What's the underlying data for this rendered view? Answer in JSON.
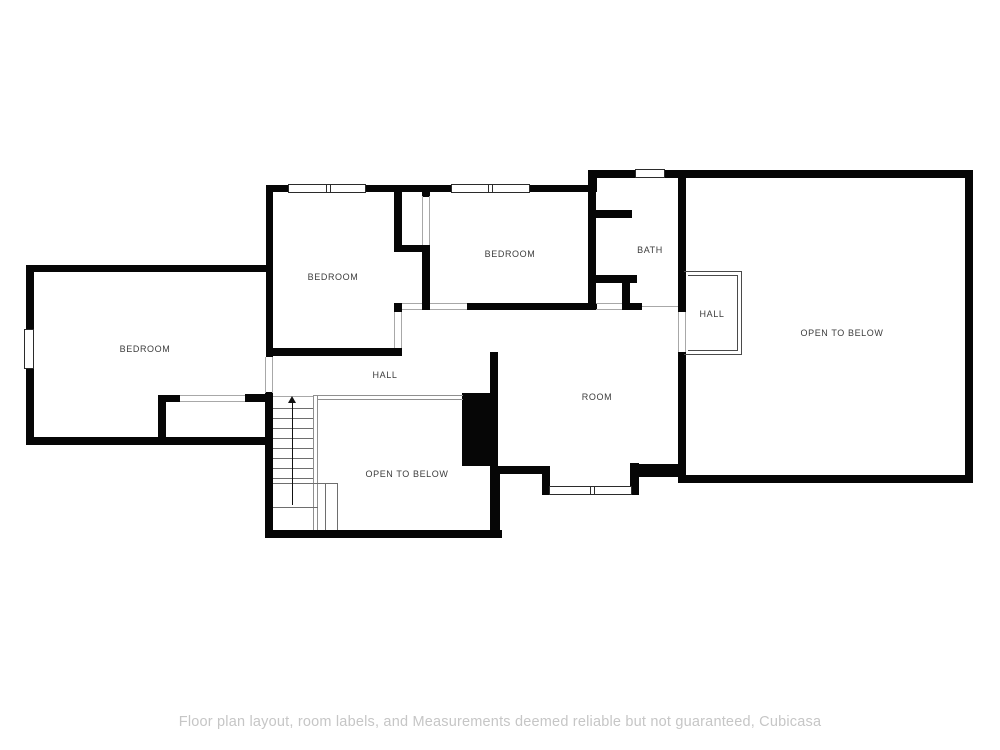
{
  "page": {
    "width": 1000,
    "height": 750,
    "background": "#ffffff"
  },
  "footer": {
    "disclaimer": "Floor plan layout, room labels, and Measurements deemed reliable but not guaranteed, Cubicasa",
    "color": "#c6c6c6"
  },
  "floorplan": {
    "colors": {
      "wall": "#060606",
      "solid_mass": "#060606",
      "window_border": "#2b2b2b",
      "opening_line": "#a8a8a8",
      "boundary_line": "#8f8f8f",
      "railing_line": "#4a4a4a",
      "stair_line": "#6e6e6e",
      "arrow": "#111111",
      "label": "#3c3c3c"
    },
    "labels": [
      {
        "id": "bedroom-west",
        "text": "BEDROOM",
        "x": 145,
        "y": 349
      },
      {
        "id": "bedroom-mid",
        "text": "BEDROOM",
        "x": 333,
        "y": 277
      },
      {
        "id": "bedroom-north",
        "text": "BEDROOM",
        "x": 510,
        "y": 254
      },
      {
        "id": "bath",
        "text": "BATH",
        "x": 650,
        "y": 250
      },
      {
        "id": "hall-east",
        "text": "HALL",
        "x": 712,
        "y": 314
      },
      {
        "id": "hall-west",
        "text": "HALL",
        "x": 385,
        "y": 375
      },
      {
        "id": "room",
        "text": "ROOM",
        "x": 597,
        "y": 397
      },
      {
        "id": "open-to-below-east",
        "text": "OPEN TO BELOW",
        "x": 842,
        "y": 333
      },
      {
        "id": "open-to-below-stair",
        "text": "OPEN TO BELOW",
        "x": 407,
        "y": 474
      }
    ],
    "walls": [
      [
        266,
        185,
        24,
        7
      ],
      [
        364,
        185,
        89,
        7
      ],
      [
        528,
        185,
        62,
        7
      ],
      [
        588,
        170,
        9,
        22
      ],
      [
        588,
        170,
        49,
        8
      ],
      [
        663,
        170,
        310,
        8
      ],
      [
        965,
        170,
        8,
        313
      ],
      [
        678,
        475,
        295,
        8
      ],
      [
        678,
        170,
        8,
        142
      ],
      [
        678,
        352,
        8,
        131
      ],
      [
        266,
        185,
        7,
        172
      ],
      [
        26,
        265,
        247,
        7
      ],
      [
        26,
        265,
        8,
        180
      ],
      [
        26,
        437,
        247,
        8
      ],
      [
        158,
        395,
        8,
        50
      ],
      [
        158,
        395,
        22,
        7
      ],
      [
        245,
        394,
        28,
        8
      ],
      [
        265,
        392,
        8,
        146
      ],
      [
        265,
        530,
        237,
        8
      ],
      [
        490,
        466,
        10,
        72
      ],
      [
        266,
        348,
        136,
        8
      ],
      [
        394,
        192,
        8,
        58
      ],
      [
        394,
        245,
        36,
        7
      ],
      [
        422,
        245,
        8,
        65
      ],
      [
        394,
        303,
        8,
        9
      ],
      [
        422,
        192,
        8,
        5
      ],
      [
        467,
        303,
        130,
        7
      ],
      [
        588,
        170,
        8,
        140
      ],
      [
        596,
        210,
        36,
        8
      ],
      [
        596,
        275,
        41,
        8
      ],
      [
        622,
        275,
        8,
        35
      ],
      [
        622,
        303,
        20,
        7
      ],
      [
        490,
        352,
        8,
        48
      ],
      [
        498,
        466,
        52,
        8
      ],
      [
        542,
        466,
        8,
        29
      ],
      [
        630,
        463,
        9,
        32
      ],
      [
        639,
        464,
        43,
        13
      ]
    ],
    "solids": [
      [
        462,
        393,
        36,
        73
      ]
    ],
    "windows": [
      {
        "rect": [
          288,
          184,
          78,
          9
        ],
        "mullion_x": 327
      },
      {
        "rect": [
          451,
          184,
          79,
          9
        ],
        "mullion_x": 489
      },
      {
        "rect": [
          635,
          169,
          30,
          9
        ],
        "mullion_x": null
      },
      {
        "rect": [
          24,
          329,
          10,
          40
        ],
        "mullion_x": null
      },
      {
        "rect": [
          549,
          486,
          83,
          9
        ],
        "mullion_x": 591
      }
    ],
    "opening_lines": [
      [
        265,
        357,
        1,
        36
      ],
      [
        272,
        357,
        1,
        36
      ],
      [
        394,
        312,
        1,
        36
      ],
      [
        401,
        312,
        1,
        36
      ],
      [
        430,
        303,
        37,
        1
      ],
      [
        430,
        309,
        37,
        1
      ],
      [
        422,
        196,
        1,
        49
      ],
      [
        429,
        196,
        1,
        49
      ],
      [
        402,
        303,
        20,
        1
      ],
      [
        402,
        309,
        20,
        1
      ],
      [
        596,
        303,
        26,
        1
      ],
      [
        596,
        309,
        26,
        1
      ],
      [
        642,
        306,
        36,
        1
      ],
      [
        180,
        395,
        65,
        1
      ],
      [
        180,
        401,
        65,
        1
      ],
      [
        273,
        396,
        40,
        1
      ],
      [
        678,
        312,
        1,
        40
      ],
      [
        685,
        312,
        1,
        40
      ]
    ],
    "railing_lines": [
      [
        684,
        271,
        58,
        1
      ],
      [
        741,
        271,
        1,
        84
      ],
      [
        684,
        354,
        58,
        1
      ],
      [
        688,
        275,
        50,
        1
      ],
      [
        737,
        275,
        1,
        76
      ],
      [
        688,
        350,
        50,
        1
      ]
    ],
    "boundary_lines": [
      [
        313,
        395,
        1,
        135
      ],
      [
        317,
        395,
        1,
        135
      ],
      [
        313,
        395,
        150,
        1
      ],
      [
        317,
        399,
        146,
        1
      ]
    ],
    "stair": {
      "treads": [
        [
          273,
          408,
          40,
          1
        ],
        [
          273,
          418,
          40,
          1
        ],
        [
          273,
          428,
          40,
          1
        ],
        [
          273,
          438,
          40,
          1
        ],
        [
          273,
          448,
          40,
          1
        ],
        [
          273,
          458,
          40,
          1
        ],
        [
          273,
          468,
          40,
          1
        ],
        [
          273,
          478,
          40,
          1
        ],
        [
          273,
          483,
          64,
          1
        ],
        [
          325,
          483,
          1,
          47
        ],
        [
          337,
          483,
          1,
          47
        ],
        [
          273,
          507,
          45,
          1
        ]
      ],
      "arrow": {
        "line": [
          292,
          402,
          1,
          103
        ],
        "head_x": 288,
        "head_y": 396,
        "head_w": 8,
        "head_h": 7
      }
    }
  }
}
